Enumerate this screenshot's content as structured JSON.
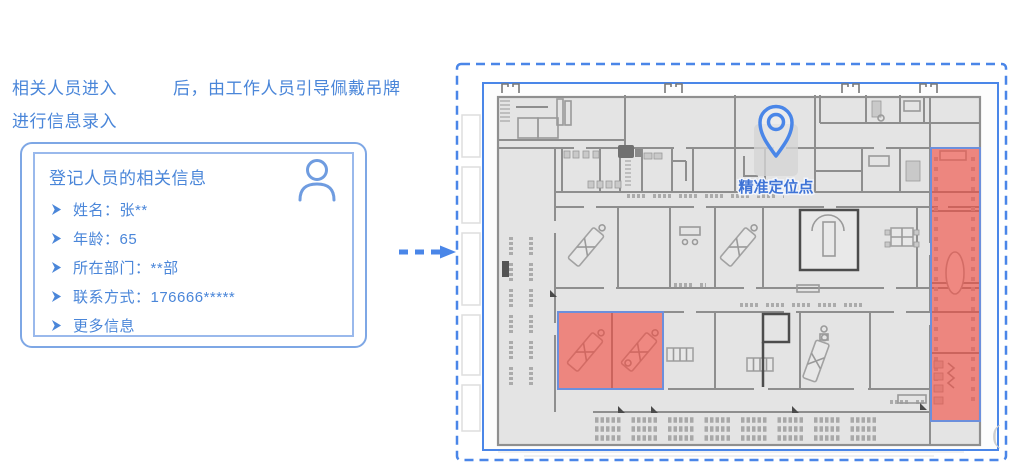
{
  "colors": {
    "accent": "#4a86e8",
    "text": "#4a86d9",
    "cardBorder": "#7ea7e5",
    "cardBorderInner": "#9ab9ec",
    "red": "#f4483c",
    "redBorder": "#6c8fdc",
    "pinText": "#3e73d6",
    "planBg": "#e4e4e4",
    "wall": "#8e8e8e"
  },
  "intro": {
    "line1_part1": "相关人员进入",
    "line1_part2": "后，由工作人员引导佩戴吊牌",
    "line2": "进行信息录入"
  },
  "card": {
    "title": "登记人员的相关信息",
    "items": [
      "姓名：张**",
      "年龄：65",
      "所在部门：**部",
      "联系方式：176666*****",
      "更多信息"
    ]
  },
  "floor_plan": {
    "pin_label": "精准定位点",
    "highlight_zones": [
      "bottom-left-double-room",
      "right-vertical-corridor"
    ]
  }
}
